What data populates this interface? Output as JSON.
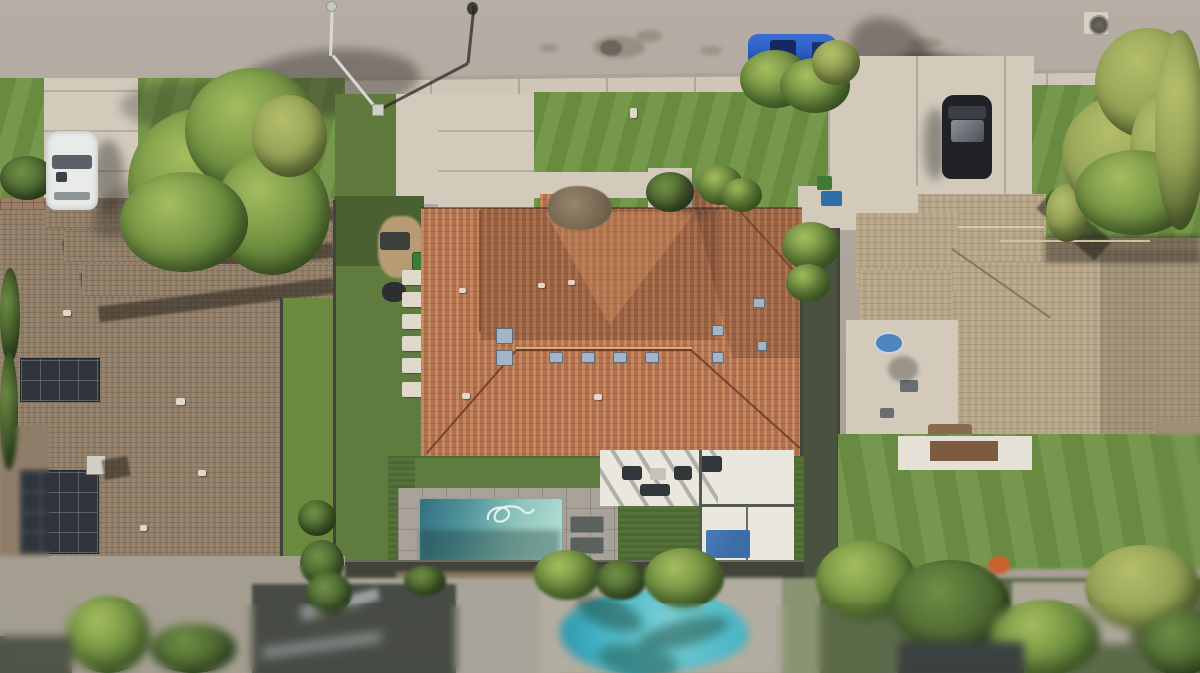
{
  "scene": {
    "description": "Aerial drone top-down photograph of a suburban residential neighborhood: a central home with terracotta tile roof, backyard swimming pool, white pergola patio and artificial turf; a left neighbor with gray-brown tile roof and rooftop solar panels; a right neighbor with tan tile roof and courtyard; a street with parked blue SUV, white car and black car; large trees, hedges, and a blurred neighboring yard with a turquoise pool at the bottom (tilt-shift effect).",
    "objects": [
      "street",
      "sidewalk",
      "street-lamp",
      "manhole-cover",
      "blue-suv",
      "white-car",
      "black-car",
      "left-house-roof",
      "solar-panel-arrays",
      "chimney",
      "center-house-roof",
      "roof-skylights",
      "ridge-vents",
      "dried-shrub",
      "right-house-roof",
      "courtyard",
      "kiddie-pool",
      "swimming-pool",
      "pool-hose",
      "sun-loungers",
      "pool-deck",
      "pergola-patio",
      "patio-furniture",
      "blue-tarp",
      "artificial-turf",
      "stepping-stones",
      "bbq-grill",
      "trash-bins",
      "fences",
      "trees",
      "hedges",
      "front-lawns",
      "driveways",
      "paver-driveway",
      "neighbor-pool",
      "shed"
    ],
    "colors": {
      "street": "#b6ada4",
      "streetDark": "#a89f96",
      "sidewalk": "#cfc6b8",
      "concrete": "#d3cabc",
      "paver": "#9d7d68",
      "lawn": "#6f9242",
      "lawnLight": "#7fa24a",
      "turf": "#516e36",
      "treeMain": "#6f8f40",
      "treeLight": "#a4bd5e",
      "treeDark": "#4c672e",
      "roofCenter": "#b06f4e",
      "roofCenterLight": "#c58a60",
      "roofLeft": "#8d7b66",
      "roofRight": "#b3a286",
      "solar": "#2f353b",
      "poolDeck": "#a9a298",
      "poolDeep": "#2f6b7e",
      "poolLight": "#abd9cf",
      "poolNeighbor": "#3fb0c2",
      "poolNeighborLight": "#7fd4d8",
      "patio": "#eae7df",
      "tarp": "#3c6da6",
      "fence": "#42433a",
      "shadow": "rgba(45,42,38,0.42)",
      "carBlue": "#2a5ec4",
      "carWhite": "#e9ebe8",
      "carBlack": "#202226",
      "binGreen": "#3f7a38",
      "binBlue": "#2f6ea8",
      "soil": "#b89a74",
      "shrubDry": "#8b7b63",
      "orangeBush": "#c8622e"
    }
  }
}
